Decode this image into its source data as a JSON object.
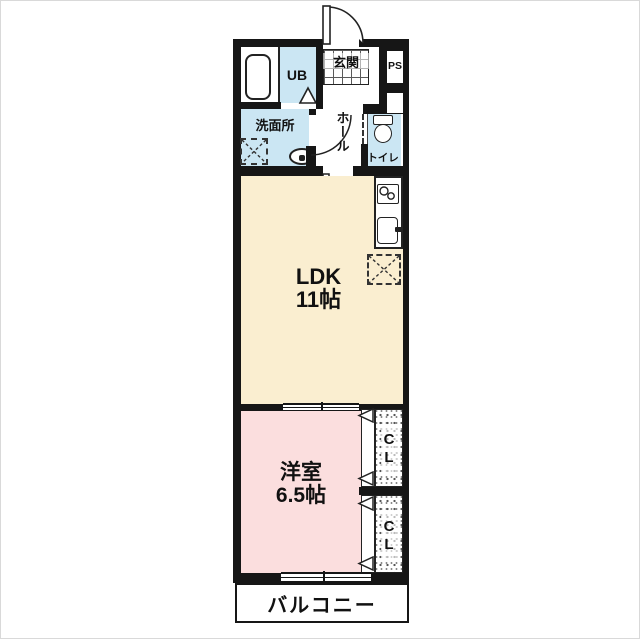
{
  "plan": {
    "title": "1LDK floor plan",
    "rooms": {
      "genkan": {
        "label": "玄関"
      },
      "ps": {
        "label": "PS"
      },
      "ub": {
        "label": "UB"
      },
      "senmenjo": {
        "label": "洗面所"
      },
      "hall": {
        "label": "ホール"
      },
      "toilet": {
        "label": "トイレ"
      },
      "ldk": {
        "label": "LDK",
        "size": "11帖"
      },
      "bedroom": {
        "label": "洋室",
        "size": "6.5帖"
      },
      "cl1": {
        "label": "CL"
      },
      "cl2": {
        "label": "CL"
      },
      "balcony": {
        "label": "バルコニー"
      }
    },
    "colors": {
      "wall": "#161616",
      "water": "#cbe6f3",
      "ldk": "#faeed0",
      "bedroom": "#fbdede"
    }
  }
}
